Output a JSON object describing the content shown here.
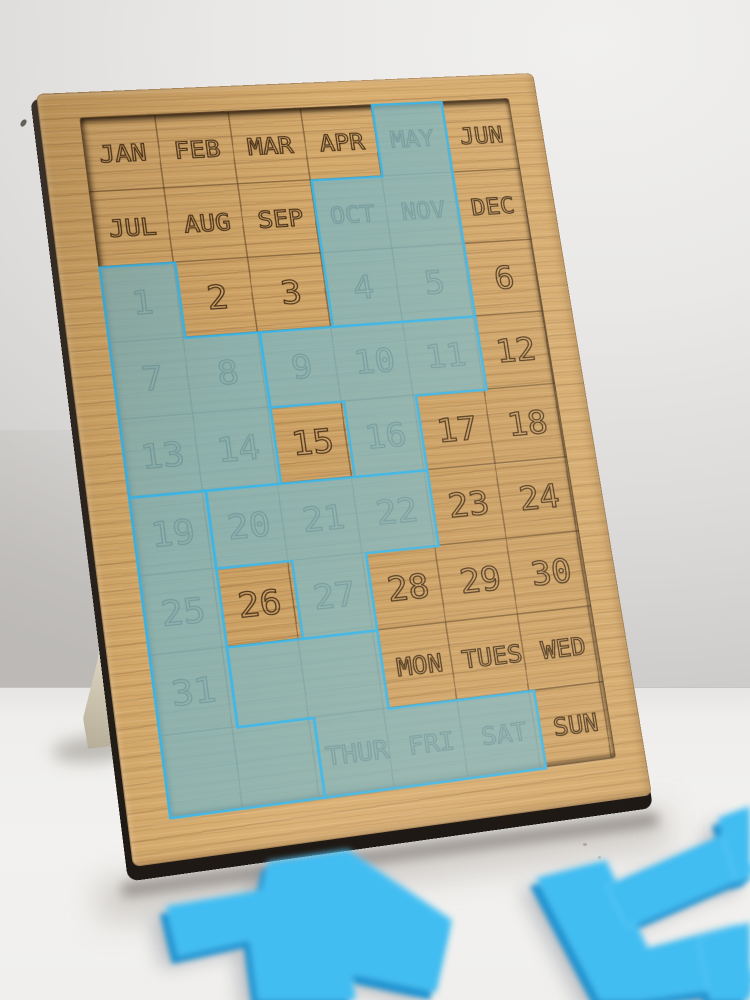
{
  "scene": {
    "description": "Wooden perpetual-calendar puzzle board standing upright on a white table against a light grey wall; translucent frosted blue acrylic polyomino pieces cover part of the engraved calendar grid, and loose bright blue acrylic pieces lie out of focus on the table in front.",
    "objects": [
      "wooden-calendar-puzzle-board",
      "paper-stand-leg",
      "acrylic-pieces-on-board",
      "loose-acrylic-pieces",
      "table-surface",
      "wall-background"
    ]
  },
  "board": {
    "grid": {
      "columns": 6,
      "rows_count": 9,
      "rows": [
        [
          "JAN",
          "FEB",
          "MAR",
          "APR",
          "MAY",
          "JUN"
        ],
        [
          "JUL",
          "AUG",
          "SEP",
          "OCT",
          "NOV",
          "DEC"
        ],
        [
          "1",
          "2",
          "3",
          "4",
          "5",
          "6"
        ],
        [
          "7",
          "8",
          "9",
          "10",
          "11",
          "12"
        ],
        [
          "13",
          "14",
          "15",
          "16",
          "17",
          "18"
        ],
        [
          "19",
          "20",
          "21",
          "22",
          "23",
          "24"
        ],
        [
          "25",
          "26",
          "27",
          "28",
          "29",
          "30"
        ],
        [
          "31",
          "",
          "",
          "MON",
          "TUES",
          "WED"
        ],
        [
          "",
          "",
          "THUR",
          "FRI",
          "SAT",
          "SUN"
        ]
      ]
    },
    "uncovered_labels": [
      "JAN",
      "FEB",
      "MAR",
      "APR",
      "JUN",
      "JUL",
      "AUG",
      "SEP",
      "DEC",
      "2",
      "3",
      "6",
      "12",
      "15",
      "17",
      "18",
      "23",
      "24",
      "26",
      "28",
      "29",
      "30",
      "MON",
      "TUES",
      "WED",
      "SUN"
    ],
    "covered_labels": [
      "MAY",
      "OCT",
      "NOV",
      "1",
      "4",
      "5",
      "7",
      "8",
      "9",
      "10",
      "11",
      "13",
      "14",
      "16",
      "19",
      "20",
      "21",
      "22",
      "25",
      "27",
      "31",
      "THUR",
      "FRI",
      "SAT"
    ],
    "pieces_on_board": [
      {
        "name": "piece-covering-may-oct-nov-4-5",
        "cells": "MAY, OCT, NOV, 4, 5",
        "outline": "288,0 360,0 360,237 216,237 216,79 288,79"
      },
      {
        "name": "piece-covering-1-7-8-13-14",
        "cells": "1, 7, 8, 13, 14",
        "outline": "0,158 72,158 72,237 144,237 144,395 0,395"
      },
      {
        "name": "piece-covering-9-10-11-16",
        "cells": "9, 10, 11, 16",
        "outline": "144,237 360,237 360,316 288,316 288,395 216,395 216,316 144,316"
      },
      {
        "name": "piece-covering-19-25-31-bottom-left",
        "cells": "19, 25, 31, blank, blank",
        "outline": "0,395 72,395 72,632 144,632 144,711 0,711"
      },
      {
        "name": "piece-covering-20-21-22-27",
        "cells": "20, 21, 22, 27",
        "outline": "72,395 288,395 288,474 216,474 216,553 144,553 144,474 72,474"
      },
      {
        "name": "piece-covering-thur-fri-sat",
        "cells": "blank, blank, THUR, FRI, SAT",
        "outline": "72,553 216,553 216,632 360,632 360,711 144,711 144,632 72,632"
      }
    ],
    "colors": {
      "wood_light": "#d8ad70",
      "wood_base": "#c99c5e",
      "wood_grain_dark": "#5c3c1c",
      "engraving": "#3e2812",
      "acrylic_on_board_fill": "#7fb5be",
      "acrylic_edge_cyan": "#3ab5e8",
      "board_side_edge": "#2a231d"
    }
  },
  "loose_pieces": {
    "color_top": "#41bdf2",
    "color_side": "#1b90cf",
    "items": [
      {
        "name": "loose-piece-plus-shape",
        "points": "268,862 348,850 452,920 436,992 352,974 356,1000 258,1000 250,940 178,956 166,906 262,890"
      },
      {
        "name": "loose-piece-corner-shape",
        "points": "536,878 606,860 648,948 738,924 756,984 640,1000 600,1000"
      },
      {
        "name": "loose-piece-bar",
        "points": "606,886 734,830 756,872 628,928"
      },
      {
        "name": "loose-piece-right-edge-fragment",
        "points": "718,818 750,806 750,878 736,882"
      },
      {
        "name": "loose-piece-bottom-right-fragment",
        "points": "698,938 750,922 750,1000 710,1000"
      }
    ]
  }
}
